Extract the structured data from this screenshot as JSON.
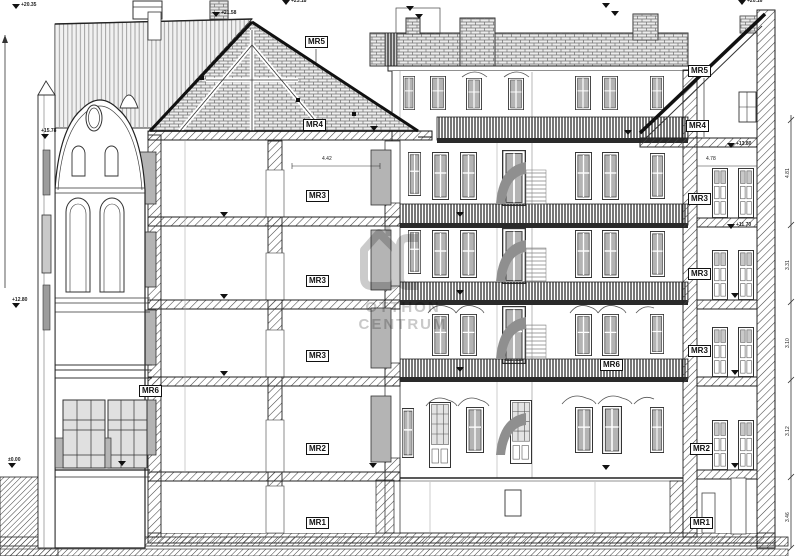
{
  "drawing": {
    "kind": "building cross-section",
    "room_labels": [
      {
        "id": "left-mr5",
        "text": "MR5"
      },
      {
        "id": "left-mr4",
        "text": "MR4"
      },
      {
        "id": "left-mr3-top",
        "text": "MR3"
      },
      {
        "id": "left-mr3-mid",
        "text": "MR3"
      },
      {
        "id": "left-mr3-low",
        "text": "MR3"
      },
      {
        "id": "left-mr6",
        "text": "MR6"
      },
      {
        "id": "left-mr2",
        "text": "MR2"
      },
      {
        "id": "left-mr1",
        "text": "MR1"
      },
      {
        "id": "right-mr5",
        "text": "MR5"
      },
      {
        "id": "right-mr4",
        "text": "MR4"
      },
      {
        "id": "right-mr3-top",
        "text": "MR3"
      },
      {
        "id": "right-mr3-mid",
        "text": "MR3"
      },
      {
        "id": "right-mr3-low",
        "text": "MR3"
      },
      {
        "id": "right-mr6",
        "text": "MR6"
      },
      {
        "id": "right-mr2",
        "text": "MR2"
      },
      {
        "id": "right-mr1",
        "text": "MR1"
      }
    ],
    "level_markers": [
      {
        "value": "+20.35"
      },
      {
        "value": "+23.18"
      },
      {
        "value": "+21.58"
      },
      {
        "value": "+20.16"
      },
      {
        "value": "+15.78"
      },
      {
        "value": "+12.80"
      },
      {
        "value": "±0.00"
      },
      {
        "value": "+13.80"
      },
      {
        "value": "+11.70"
      }
    ],
    "dimensions": {
      "attic_left": "4.42",
      "attic_right": "4.78",
      "right_chain": [
        "4.81",
        "3.31",
        "3.10",
        "3.12",
        "3.46"
      ]
    },
    "watermark": {
      "line1": "OTTHON",
      "line2": "CENTRUM",
      "color": "#c6c6c6"
    }
  }
}
